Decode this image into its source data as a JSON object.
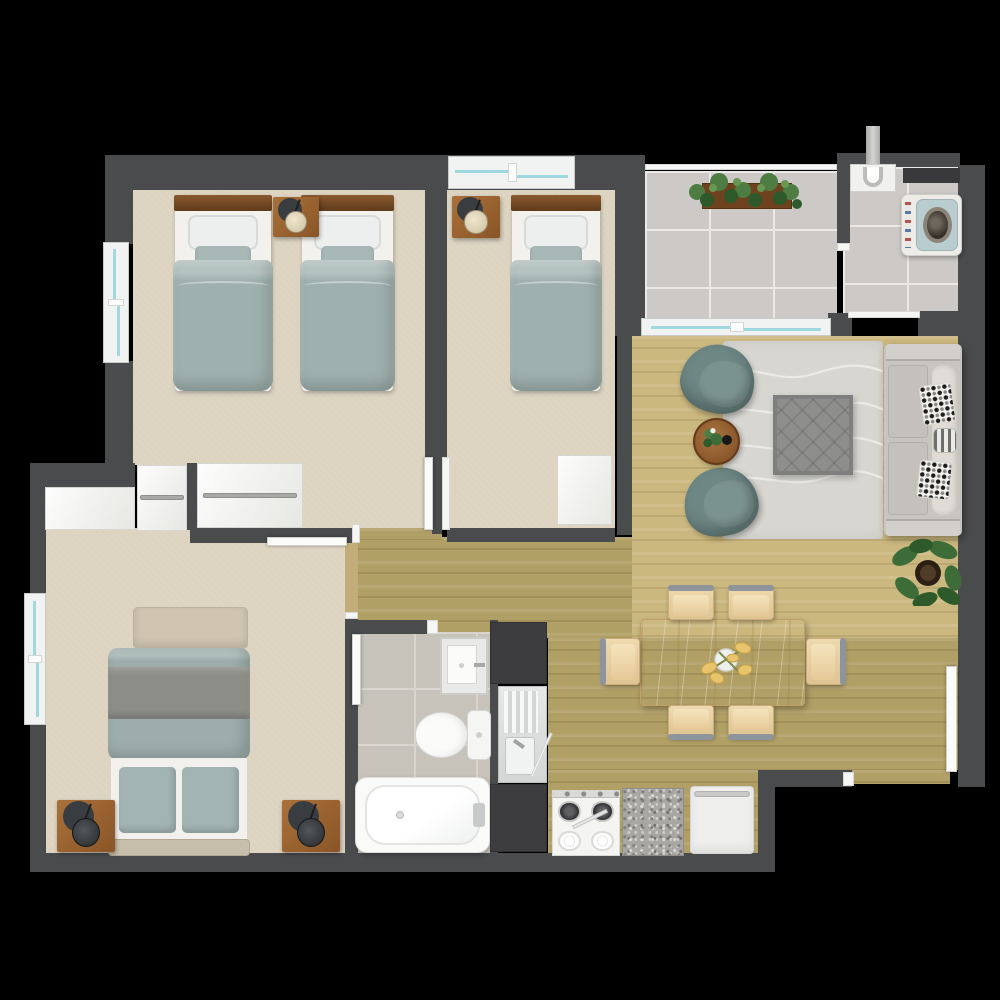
{
  "title": "apartment-floor-plan",
  "palette": {
    "background": "#000000",
    "wall": "#4a4b4d",
    "carpet": "#dcd3c0",
    "wood_light": "#cbb87f",
    "wood_olive": "#b1a066",
    "tile": "#ccc9c6",
    "bath_tile": "#c7c3bb",
    "window_glass": "#9fd8de",
    "duvet_teal": "#9fb1ae",
    "armchair_teal": "#6d8784",
    "sofa_gray": "#c8c5c0",
    "table_oak": "#ddc197",
    "nightstand_wood": "#9a6434",
    "counter_dark": "#3d3d3f"
  },
  "rooms": [
    {
      "id": "bedroom-1",
      "label": "twin bedroom with two single beds"
    },
    {
      "id": "bedroom-2",
      "label": "single bedroom"
    },
    {
      "id": "master-bedroom",
      "label": "master bedroom with double bed"
    },
    {
      "id": "bathroom",
      "label": "bathroom with tub, toilet, vanity"
    },
    {
      "id": "hallway",
      "label": "hallway"
    },
    {
      "id": "living-room",
      "label": "living room with sofa and armchairs"
    },
    {
      "id": "dining-area",
      "label": "dining area with table for six"
    },
    {
      "id": "kitchen",
      "label": "kitchen strip with stove and sink"
    },
    {
      "id": "patio",
      "label": "tiled patio with planter"
    },
    {
      "id": "laundry",
      "label": "laundry with washing machine"
    },
    {
      "id": "entry",
      "label": "entry door at bottom right"
    }
  ],
  "elements": [
    {
      "name": "bedroom1-floor",
      "type": "carpet",
      "x": 133,
      "y": 188,
      "w": 292,
      "h": 277
    },
    {
      "name": "bedroom1-vestibule-floor",
      "type": "carpet",
      "x": 303,
      "y": 463,
      "w": 122,
      "h": 65
    },
    {
      "name": "bedroom2-floor",
      "type": "carpet",
      "x": 447,
      "y": 188,
      "w": 168,
      "h": 340
    },
    {
      "name": "master-bedroom-floor",
      "type": "carpet",
      "x": 45,
      "y": 528,
      "w": 300,
      "h": 325
    },
    {
      "name": "hallway-floor",
      "type": "wood-mid",
      "x": 352,
      "y": 537,
      "w": 289,
      "h": 101
    },
    {
      "name": "hallway-floor-strip",
      "type": "wood-mid",
      "x": 358,
      "y": 528,
      "w": 84,
      "h": 12
    },
    {
      "name": "living-room-floor",
      "type": "wood-light",
      "x": 632,
      "y": 336,
      "w": 326,
      "h": 302
    },
    {
      "name": "dining-floor",
      "type": "wood-mid",
      "x": 548,
      "y": 638,
      "w": 410,
      "h": 132
    },
    {
      "name": "kitchen-floor",
      "type": "wood-mid",
      "x": 548,
      "y": 770,
      "w": 210,
      "h": 88
    },
    {
      "name": "entry-floor",
      "type": "wood-mid",
      "x": 850,
      "y": 770,
      "w": 100,
      "h": 14
    },
    {
      "name": "patio-floor",
      "type": "tile",
      "x": 645,
      "y": 171,
      "w": 192,
      "h": 147
    },
    {
      "name": "laundry-floor",
      "type": "tile",
      "x": 843,
      "y": 167,
      "w": 115,
      "h": 151
    },
    {
      "name": "bathroom-floor",
      "type": "tile-bath",
      "x": 352,
      "y": 632,
      "w": 138,
      "h": 221
    },
    {
      "name": "master-door-threshold",
      "type": "threshold",
      "x": 345,
      "y": 543,
      "w": 13,
      "h": 77
    },
    {
      "name": "wall-top",
      "type": "wall",
      "x": 105,
      "y": 155,
      "w": 512,
      "h": 35
    },
    {
      "name": "wall-left-upper",
      "type": "wall",
      "x": 105,
      "y": 188,
      "w": 28,
      "h": 56
    },
    {
      "name": "wall-left-mid",
      "type": "wall",
      "x": 105,
      "y": 361,
      "w": 28,
      "h": 104
    },
    {
      "name": "wall-corner-l",
      "type": "wall",
      "x": 30,
      "y": 463,
      "w": 105,
      "h": 27
    },
    {
      "name": "wall-master-left-up",
      "type": "wall",
      "x": 30,
      "y": 488,
      "w": 16,
      "h": 107
    },
    {
      "name": "wall-master-left-low",
      "type": "wall",
      "x": 30,
      "y": 723,
      "w": 16,
      "h": 132
    },
    {
      "name": "wall-bottom-main",
      "type": "wall",
      "x": 30,
      "y": 853,
      "w": 740,
      "h": 19
    },
    {
      "name": "wall-b1-b2",
      "type": "wall",
      "x": 425,
      "y": 188,
      "w": 22,
      "h": 270
    },
    {
      "name": "wall-b1-b2-stub",
      "type": "wall",
      "x": 432,
      "y": 458,
      "w": 10,
      "h": 76
    },
    {
      "name": "wall-b2-bottom",
      "type": "wall",
      "x": 447,
      "y": 528,
      "w": 168,
      "h": 14
    },
    {
      "name": "wall-master-top",
      "type": "wall",
      "x": 190,
      "y": 528,
      "w": 168,
      "h": 15
    },
    {
      "name": "wall-master-right",
      "type": "wall",
      "x": 345,
      "y": 618,
      "w": 13,
      "h": 235
    },
    {
      "name": "wall-b2-patio",
      "type": "wall",
      "x": 615,
      "y": 155,
      "w": 30,
      "h": 181
    },
    {
      "name": "wall-b2-living",
      "type": "wall",
      "x": 617,
      "y": 335,
      "w": 15,
      "h": 200
    },
    {
      "name": "wall-laundry-top",
      "type": "wall",
      "x": 837,
      "y": 153,
      "w": 123,
      "h": 14
    },
    {
      "name": "wall-patio-laundry",
      "type": "wall",
      "x": 837,
      "y": 153,
      "w": 13,
      "h": 92
    },
    {
      "name": "wall-right",
      "type": "wall",
      "x": 958,
      "y": 165,
      "w": 27,
      "h": 622
    },
    {
      "name": "wall-patio-bottom-a",
      "type": "wall",
      "x": 828,
      "y": 313,
      "w": 24,
      "h": 23
    },
    {
      "name": "wall-patio-bottom-b",
      "type": "wall",
      "x": 918,
      "y": 311,
      "w": 40,
      "h": 25
    },
    {
      "name": "wall-dining-bottom",
      "type": "wall",
      "x": 758,
      "y": 770,
      "w": 94,
      "h": 17
    },
    {
      "name": "wall-dining-corner",
      "type": "wall",
      "x": 758,
      "y": 770,
      "w": 17,
      "h": 102
    },
    {
      "name": "wall-bathroom-top",
      "type": "wall",
      "x": 345,
      "y": 620,
      "w": 87,
      "h": 14
    },
    {
      "name": "wall-bathroom-kitchen",
      "type": "wall",
      "x": 490,
      "y": 620,
      "w": 8,
      "h": 233
    },
    {
      "name": "wall-closet-sliver",
      "type": "wall",
      "x": 187,
      "y": 463,
      "w": 10,
      "h": 67
    },
    {
      "name": "bedroom1-window",
      "type": "window-v",
      "x": 103,
      "y": 242,
      "w": 26,
      "h": 121
    },
    {
      "name": "master-window",
      "type": "window-v",
      "x": 24,
      "y": 593,
      "w": 22,
      "h": 132
    },
    {
      "name": "bedroom2-window",
      "type": "window-h",
      "x": 448,
      "y": 156,
      "w": 127,
      "h": 33
    },
    {
      "name": "patio-sliding-door",
      "type": "window-h",
      "x": 641,
      "y": 318,
      "w": 190,
      "h": 18
    },
    {
      "name": "patio-railing",
      "type": "jamb",
      "x": 645,
      "y": 164,
      "w": 192,
      "h": 6
    },
    {
      "name": "laundry-threshold",
      "type": "jamb",
      "x": 848,
      "y": 311,
      "w": 72,
      "h": 7
    },
    {
      "name": "laundry-opening-jamb",
      "type": "jamb",
      "x": 837,
      "y": 243,
      "w": 13,
      "h": 8
    },
    {
      "name": "bedroom2-door-leaf",
      "type": "door-v",
      "x": 424,
      "y": 457,
      "w": 9,
      "h": 73
    },
    {
      "name": "bedroom2-door-jamb",
      "type": "jamb",
      "x": 442,
      "y": 457,
      "w": 8,
      "h": 73
    },
    {
      "name": "master-door-leaf",
      "type": "door-h",
      "x": 267,
      "y": 537,
      "w": 80,
      "h": 9
    },
    {
      "name": "master-wall-jamb",
      "type": "jamb",
      "x": 352,
      "y": 524,
      "w": 8,
      "h": 19
    },
    {
      "name": "master-opening-jamb",
      "type": "jamb",
      "x": 345,
      "y": 612,
      "w": 13,
      "h": 7
    },
    {
      "name": "bathroom-door-jamb",
      "type": "jamb",
      "x": 427,
      "y": 620,
      "w": 11,
      "h": 14
    },
    {
      "name": "bathroom-door-leaf",
      "type": "door-v",
      "x": 352,
      "y": 634,
      "w": 9,
      "h": 71
    },
    {
      "name": "entry-door-jamb",
      "type": "jamb",
      "x": 843,
      "y": 772,
      "w": 11,
      "h": 14
    },
    {
      "name": "entry-door-leaf",
      "type": "door-v",
      "x": 946,
      "y": 666,
      "w": 11,
      "h": 106
    },
    {
      "name": "master-closet-plain",
      "type": "closet",
      "x": 45,
      "y": 487,
      "w": 90,
      "h": 43
    },
    {
      "name": "master-closet-rail",
      "type": "closet",
      "cls": "with-rail",
      "x": 137,
      "y": 465,
      "w": 50,
      "h": 66
    },
    {
      "name": "bedroom1-closet",
      "type": "closet",
      "cls": "with-rail",
      "x": 197,
      "y": 463,
      "w": 106,
      "h": 65
    },
    {
      "name": "bedroom2-closet",
      "type": "closet",
      "x": 557,
      "y": 455,
      "w": 55,
      "h": 70
    },
    {
      "name": "single-bed-a",
      "type": "single-bed",
      "x": 173,
      "y": 195,
      "w": 100,
      "h": 196
    },
    {
      "name": "single-bed-b",
      "type": "single-bed",
      "x": 300,
      "y": 195,
      "w": 95,
      "h": 196
    },
    {
      "name": "nightstand-bedroom1",
      "type": "nightstand",
      "x": 273,
      "y": 197,
      "w": 46,
      "h": 40
    },
    {
      "name": "nightstand-bedroom2",
      "type": "nightstand",
      "x": 452,
      "y": 196,
      "w": 48,
      "h": 42
    },
    {
      "name": "single-bed-c",
      "type": "single-bed",
      "x": 510,
      "y": 195,
      "w": 92,
      "h": 196
    },
    {
      "name": "master-foot-bench",
      "type": "bench",
      "x": 133,
      "y": 607,
      "w": 115,
      "h": 42
    },
    {
      "name": "master-bed",
      "type": "master-bed",
      "x": 108,
      "y": 648,
      "w": 142,
      "h": 208
    },
    {
      "name": "nightstand-master-left",
      "type": "nightstand",
      "cls": "dark-lamp",
      "x": 57,
      "y": 800,
      "w": 58,
      "h": 52
    },
    {
      "name": "nightstand-master-right",
      "type": "nightstand",
      "cls": "dark-lamp",
      "x": 282,
      "y": 800,
      "w": 58,
      "h": 52
    },
    {
      "name": "bathroom-vanity",
      "type": "vanity",
      "x": 440,
      "y": 637,
      "w": 48,
      "h": 58
    },
    {
      "name": "toilet",
      "type": "toilet",
      "x": 415,
      "y": 710,
      "w": 76,
      "h": 50
    },
    {
      "name": "bathtub",
      "type": "bathtub",
      "x": 355,
      "y": 777,
      "w": 135,
      "h": 76
    },
    {
      "name": "kitchen-counter-dark-upper",
      "type": "counter-dark",
      "x": 490,
      "y": 622,
      "w": 57,
      "h": 62
    },
    {
      "name": "kitchen-sink",
      "type": "sink-unit",
      "x": 498,
      "y": 686,
      "w": 49,
      "h": 97
    },
    {
      "name": "kitchen-counter-dark-lower",
      "type": "counter-dark",
      "x": 490,
      "y": 784,
      "w": 57,
      "h": 68
    },
    {
      "name": "stove",
      "type": "stove",
      "x": 552,
      "y": 790,
      "w": 68,
      "h": 66
    },
    {
      "name": "granite-counter",
      "type": "granite",
      "x": 622,
      "y": 788,
      "w": 62,
      "h": 68
    },
    {
      "name": "kitchen-cabinet",
      "type": "cabinet",
      "x": 690,
      "y": 786,
      "w": 64,
      "h": 68
    },
    {
      "name": "laundry-vent",
      "type": "vent",
      "x": 903,
      "y": 168,
      "w": 57,
      "h": 15
    },
    {
      "name": "laundry-pipe",
      "type": "pipe",
      "x": 866,
      "y": 126,
      "w": 14,
      "h": 42
    },
    {
      "name": "laundry-sink",
      "type": "laundry-sink",
      "x": 850,
      "y": 164,
      "w": 46,
      "h": 28
    },
    {
      "name": "washing-machine",
      "type": "washer",
      "x": 901,
      "y": 194,
      "w": 61,
      "h": 62
    },
    {
      "name": "patio-planter",
      "type": "planter",
      "x": 685,
      "y": 170,
      "w": 122,
      "h": 50
    },
    {
      "name": "living-rug",
      "type": "rug",
      "x": 723,
      "y": 341,
      "w": 160,
      "h": 198
    },
    {
      "name": "ottoman-coffee-table",
      "type": "ottoman",
      "x": 773,
      "y": 395,
      "w": 80,
      "h": 80
    },
    {
      "name": "armchair-north",
      "type": "armchair",
      "x": 681,
      "y": 345,
      "w": 74,
      "h": 68,
      "rot": 14
    },
    {
      "name": "armchair-south",
      "type": "armchair",
      "x": 684,
      "y": 468,
      "w": 74,
      "h": 68,
      "rot": -10
    },
    {
      "name": "round-side-table",
      "type": "side-table",
      "x": 693,
      "y": 418,
      "w": 47,
      "h": 47
    },
    {
      "name": "sofa",
      "type": "sofa",
      "x": 884,
      "y": 344,
      "w": 78,
      "h": 192
    },
    {
      "name": "monstera-plant",
      "type": "monstera",
      "x": 891,
      "y": 538,
      "w": 72,
      "h": 68
    },
    {
      "name": "dining-table",
      "type": "dining-table",
      "x": 640,
      "y": 619,
      "w": 165,
      "h": 87
    },
    {
      "name": "dining-chair-top-1",
      "type": "chair",
      "cls": "rail-n",
      "x": 668,
      "y": 587,
      "w": 46,
      "h": 33
    },
    {
      "name": "dining-chair-top-2",
      "type": "chair",
      "cls": "rail-n",
      "x": 728,
      "y": 587,
      "w": 46,
      "h": 33
    },
    {
      "name": "dining-chair-bottom-1",
      "type": "chair",
      "cls": "rail-s",
      "x": 668,
      "y": 705,
      "w": 46,
      "h": 33
    },
    {
      "name": "dining-chair-bottom-2",
      "type": "chair",
      "cls": "rail-s",
      "x": 728,
      "y": 705,
      "w": 46,
      "h": 33
    },
    {
      "name": "dining-chair-left",
      "type": "chair",
      "cls": "rail-w",
      "x": 602,
      "y": 638,
      "w": 38,
      "h": 47
    },
    {
      "name": "dining-chair-right",
      "type": "chair",
      "cls": "rail-e",
      "x": 806,
      "y": 638,
      "w": 38,
      "h": 47
    },
    {
      "name": "table-centerpiece-flowers",
      "type": "flowers",
      "x": 693,
      "y": 638,
      "w": 70,
      "h": 48
    }
  ]
}
